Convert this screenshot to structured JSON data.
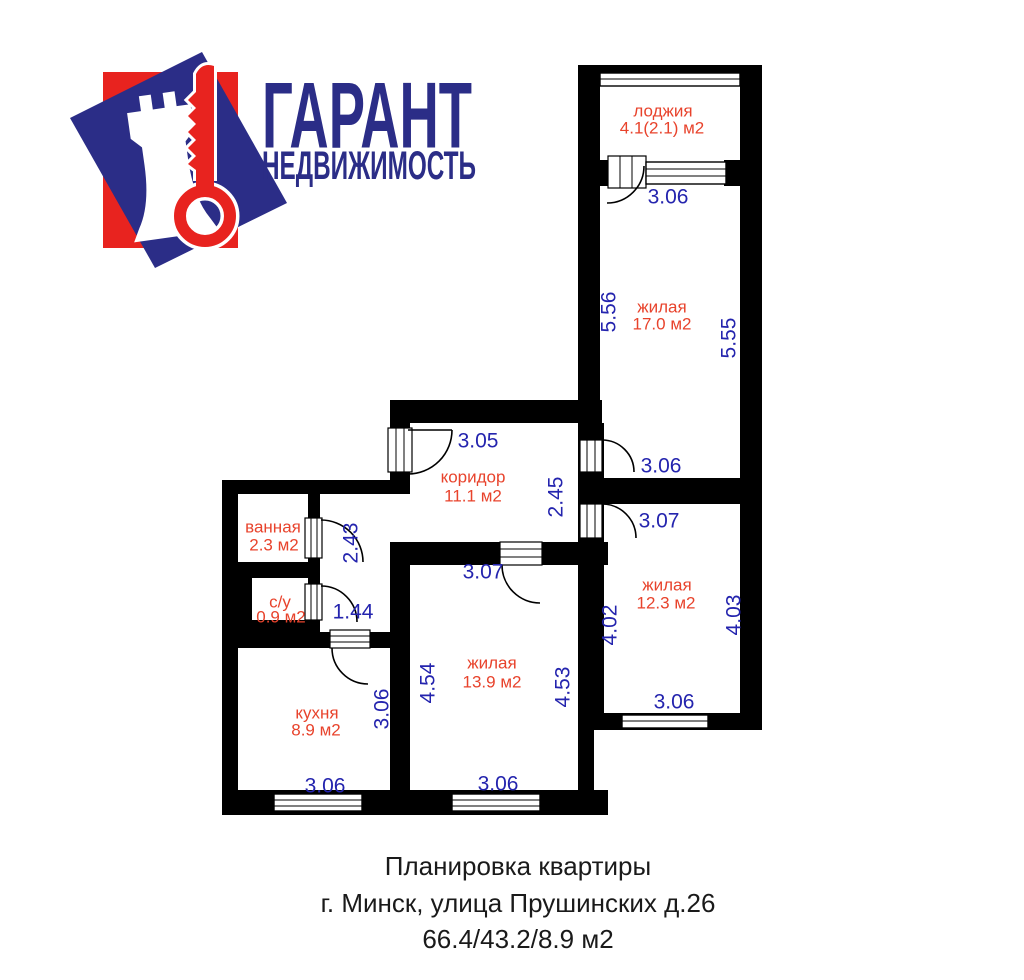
{
  "logo": {
    "title": "ГАРАНТ",
    "subtitle": "НЕДВИЖИМОСТЬ",
    "colors": {
      "navy": "#2b2d87",
      "red": "#e8231f"
    }
  },
  "plan": {
    "colors": {
      "wall": "#000000",
      "room_label": "#e8432c",
      "dimension_label": "#2424ae"
    },
    "rooms": [
      {
        "id": "loggia",
        "name": "лоджия",
        "area": "4.1(2.1) м2"
      },
      {
        "id": "living-17",
        "name": "жилая",
        "area": "17.0 м2"
      },
      {
        "id": "corridor",
        "name": "коридор",
        "area": "11.1 м2"
      },
      {
        "id": "bathroom",
        "name": "ванная",
        "area": "2.3 м2"
      },
      {
        "id": "wc",
        "name": "с/у",
        "area": "0.9 м2"
      },
      {
        "id": "kitchen",
        "name": "кухня",
        "area": "8.9 м2"
      },
      {
        "id": "living-139",
        "name": "жилая",
        "area": "13.9 м2"
      },
      {
        "id": "living-123",
        "name": "жилая",
        "area": "12.3 м2"
      }
    ],
    "dims": [
      {
        "value": "3.06"
      },
      {
        "value": "5.56"
      },
      {
        "value": "5.55"
      },
      {
        "value": "3.06"
      },
      {
        "value": "3.05"
      },
      {
        "value": "2.45"
      },
      {
        "value": "3.07"
      },
      {
        "value": "2.43"
      },
      {
        "value": "1.44"
      },
      {
        "value": "4.02"
      },
      {
        "value": "4.03"
      },
      {
        "value": "3.07"
      },
      {
        "value": "4.54"
      },
      {
        "value": "4.53"
      },
      {
        "value": "3.06"
      },
      {
        "value": "3.06"
      },
      {
        "value": "3.06"
      },
      {
        "value": "3.06"
      }
    ]
  },
  "caption": {
    "line1": "Планировка квартиры",
    "line2": "г. Минск, улица Прушинских д.26",
    "line3": "66.4/43.2/8.9 м2"
  }
}
